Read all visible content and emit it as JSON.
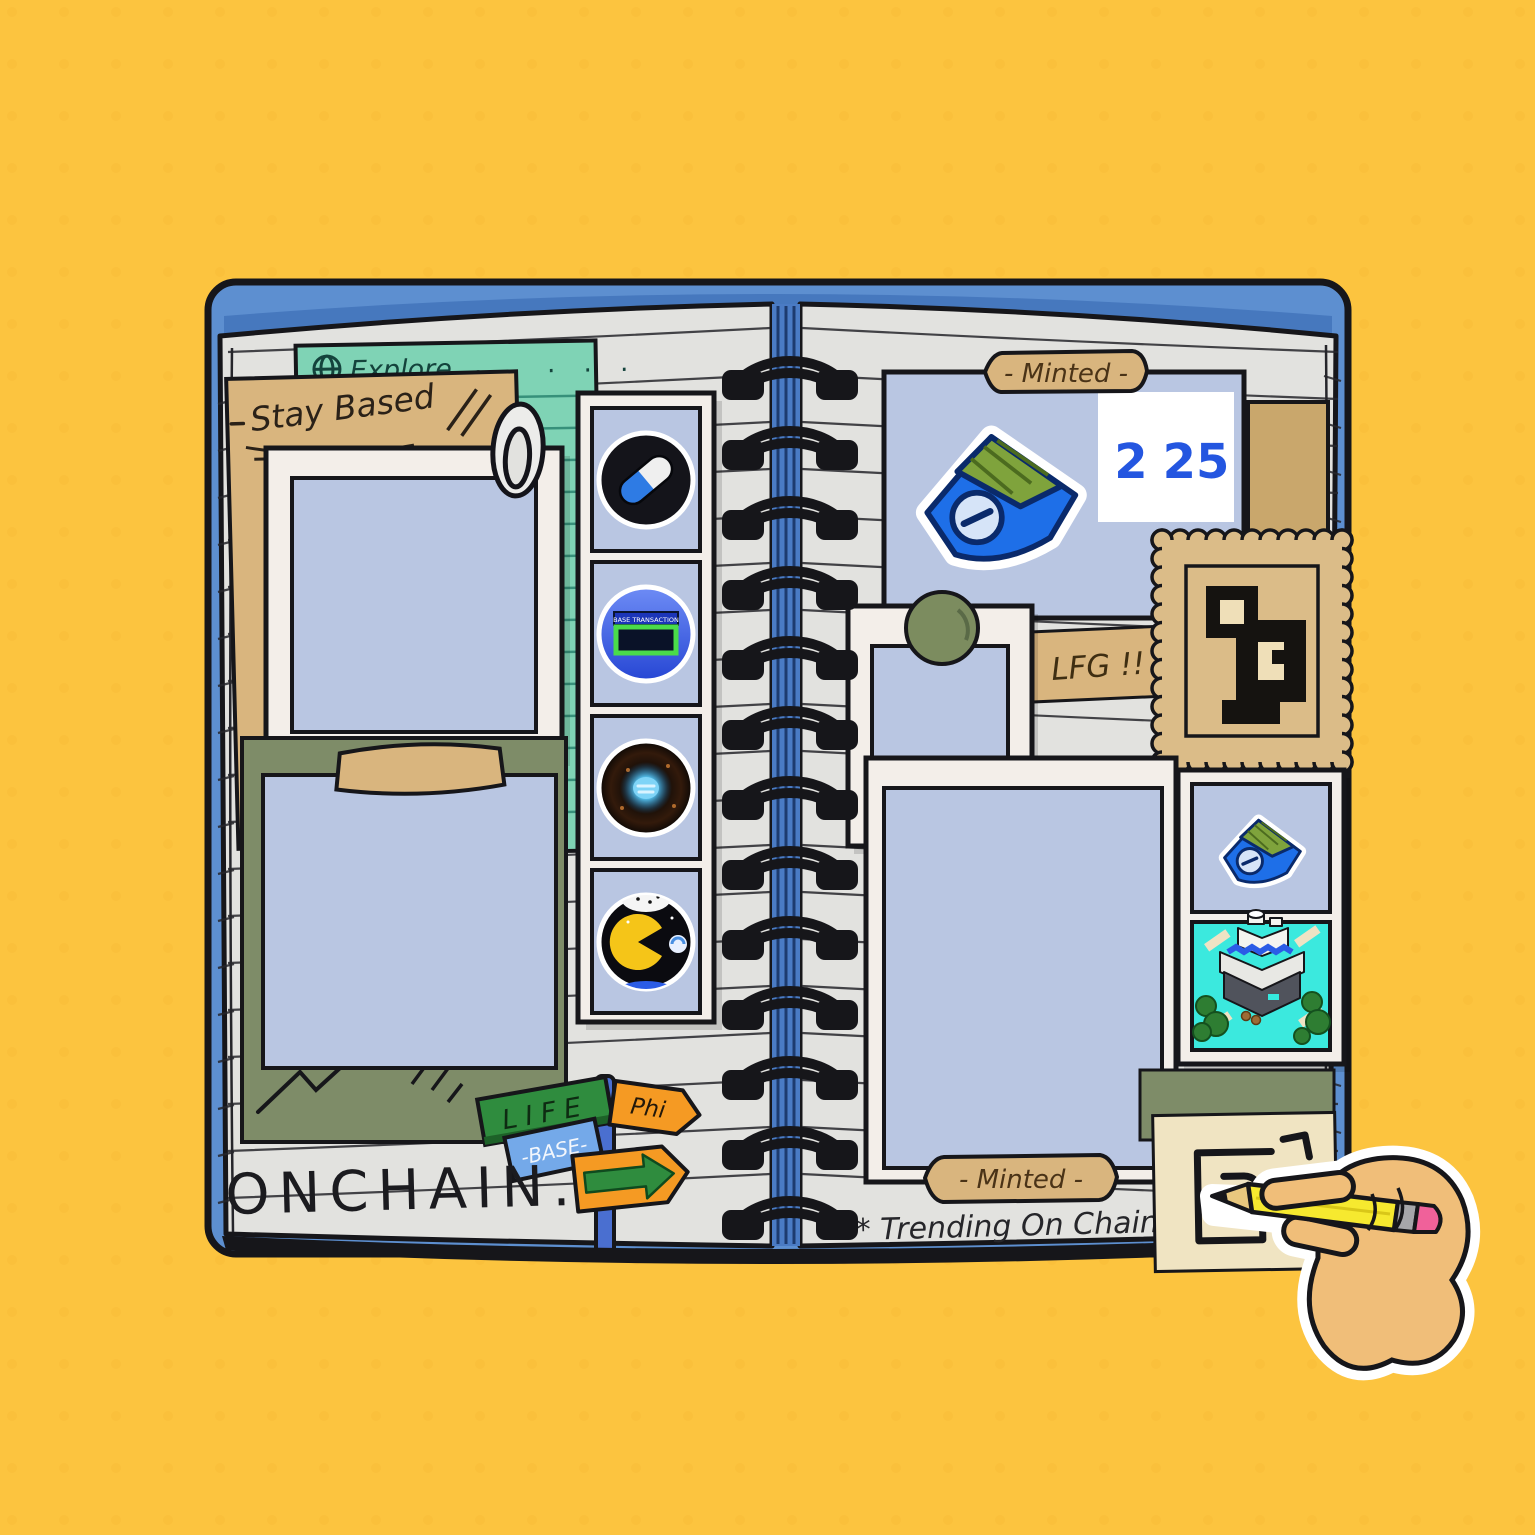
{
  "scene": "Open spiral notebook scrapbook illustration on yellow background",
  "colors": {
    "background": "#FCC43F",
    "cover_blue": "#5D8FD0",
    "page_gray": "#E2E2DF",
    "photo_blue": "#B9C6E2",
    "teal_note": "#7FD3B5",
    "kraft_tan": "#D9B57E",
    "olive_green": "#7E8C68",
    "accent_blue": "#2B5CE6",
    "sign_green": "#2F8C3E",
    "sign_orange": "#F59A23",
    "sign_blue": "#74A9E9",
    "pencil_yellow": "#F6E92F",
    "eraser_pink": "#F0619A"
  },
  "left_page": {
    "explore_note": {
      "icon": "globe",
      "label": "Explore",
      "dots": ". . . . ."
    },
    "stay_based_note": {
      "label": "Stay Based"
    },
    "film_strip": {
      "frames": [
        {
          "name": "pill-capsule"
        },
        {
          "name": "base-transaction-screen",
          "label": "BASE TRANSACTION"
        },
        {
          "name": "glowing-orb"
        },
        {
          "name": "pacman-space"
        }
      ]
    },
    "signpost": {
      "life_label": "LIFE",
      "phi_label": "Phi",
      "base_label": "-BASE-"
    },
    "onchain_label": "ONCHAIN."
  },
  "right_page": {
    "minted_tag_top": "- Minted -",
    "mint_numbers": {
      "left": "2",
      "right": "25"
    },
    "lfg_label": "LFG !!",
    "minted_tag_bottom": "- Minted -",
    "trending_label": "* Trending  On  Chain"
  }
}
